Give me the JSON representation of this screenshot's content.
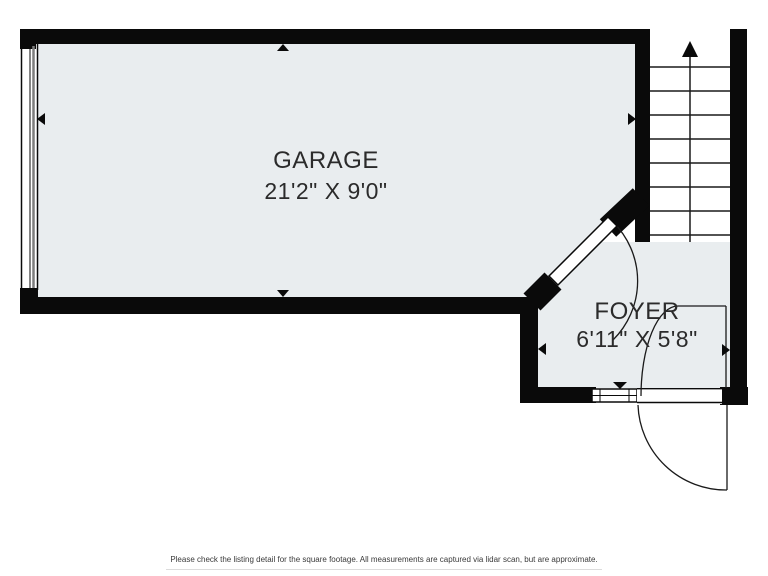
{
  "floorplan": {
    "rooms": [
      {
        "name": "GARAGE",
        "dimensions": "21'2\" X 9'0\""
      },
      {
        "name": "FOYER",
        "dimensions": "6'11\" X 5'8\""
      }
    ],
    "stairs": {
      "direction": "up"
    },
    "colors": {
      "room_fill": "#e9edef",
      "wall": "#0a0a0a",
      "line": "#1a1a1a",
      "text": "#2b2b2b"
    },
    "footer": {
      "disclaimer": "Please check the listing detail for the square footage. All measurements are captured via lidar scan, but are approximate."
    }
  }
}
